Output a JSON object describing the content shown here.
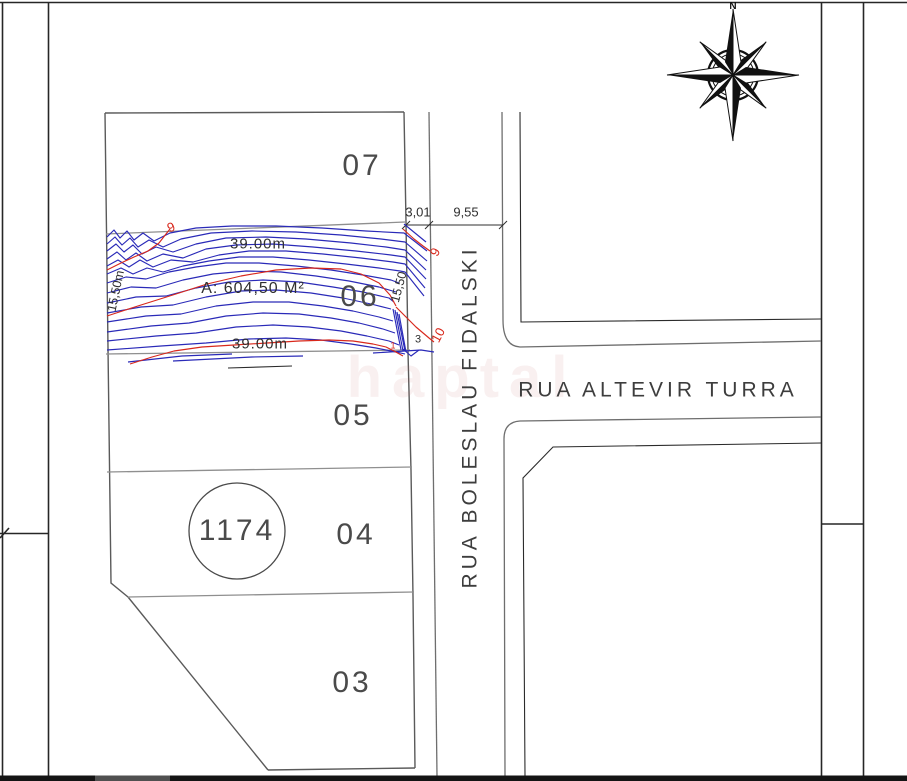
{
  "page": {
    "type": "cadastral plat drawing",
    "background": "#ffffff"
  },
  "colors": {
    "contour_blue": "#2a2ab8",
    "contour_red": "#d8281c",
    "linework_dark": "#262626",
    "linework_gray": "#8f8f8f",
    "text": "#3d3d3d",
    "bottom_bar": "#141414"
  },
  "compass": {
    "north_label": "N"
  },
  "streets": {
    "vertical_name": "RUA BOLESLAU FIDALSKI",
    "horizontal_name": "RUA ALTEVIR TURRA"
  },
  "block": {
    "number": "1174"
  },
  "lots": {
    "lot07": "07",
    "lot06": "06",
    "lot05": "05",
    "lot04": "04",
    "lot03": "03"
  },
  "survey": {
    "area_label": "A: 604,50 M²",
    "front_width": "39.00m",
    "back_width": "39.00m",
    "left_depth": "15,50m",
    "right_depth": "15,50",
    "dim_strip": "3,01",
    "dim_street_width": "9,55"
  },
  "contour_labels": {
    "elev_9_left": "9",
    "elev_9_right": "9",
    "elev_10": "10",
    "elev_3": "3",
    "elev_1": "1"
  },
  "watermark": "haptal"
}
